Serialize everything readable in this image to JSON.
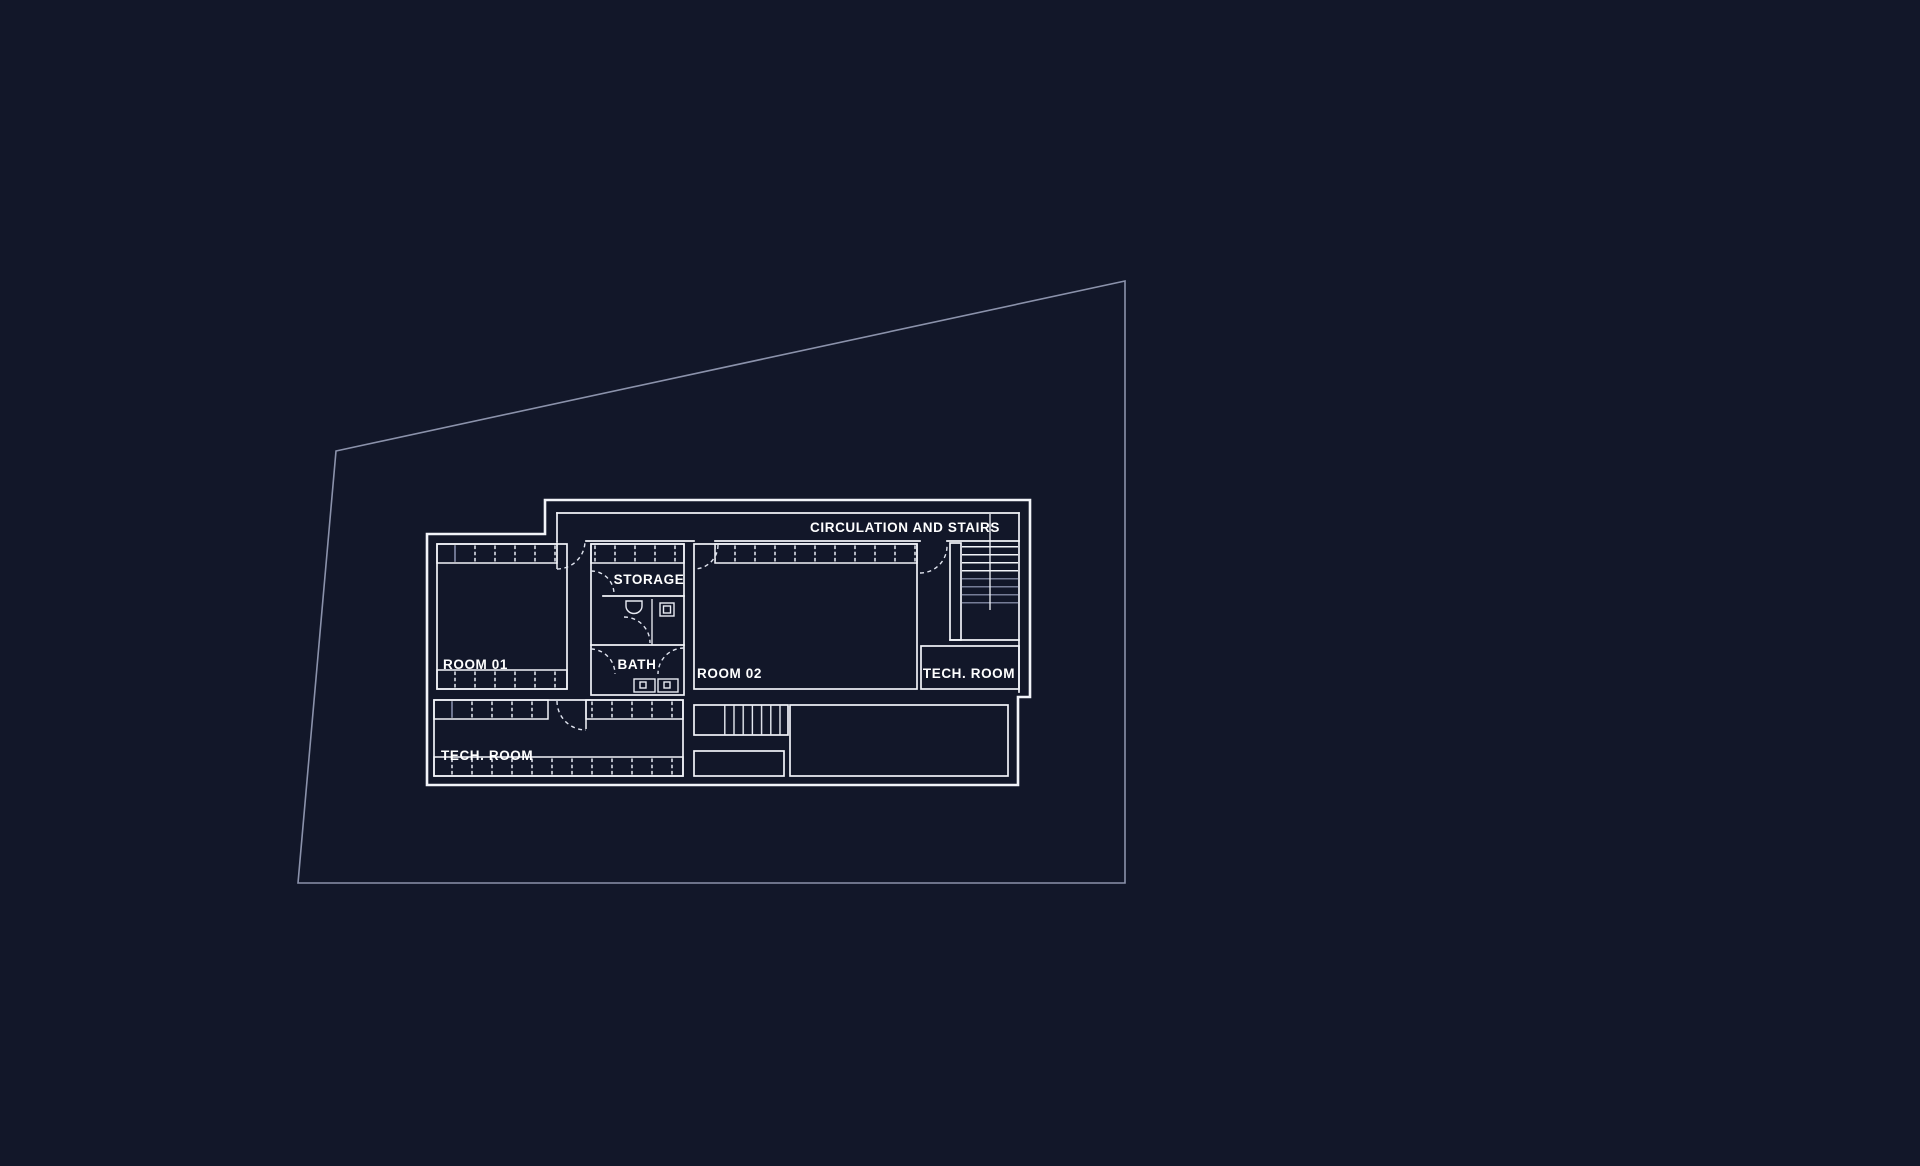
{
  "drawing": {
    "type": "floor-plan",
    "rooms": {
      "circulation": {
        "label": "CIRCULATION AND STAIRS"
      },
      "storage": {
        "label": "STORAGE"
      },
      "room01": {
        "label": "ROOM 01"
      },
      "bath": {
        "label": "BATH"
      },
      "room02": {
        "label": "ROOM 02"
      },
      "tech_room_right": {
        "label": "TECH. ROOM"
      },
      "tech_room_bottom": {
        "label": "TECH. ROOM"
      }
    }
  },
  "colors": {
    "background": "#121729",
    "wall": "#f2f4f9",
    "site_boundary": "#8b92ab",
    "dim_detail": "#767d97",
    "text": "#ffffff"
  }
}
